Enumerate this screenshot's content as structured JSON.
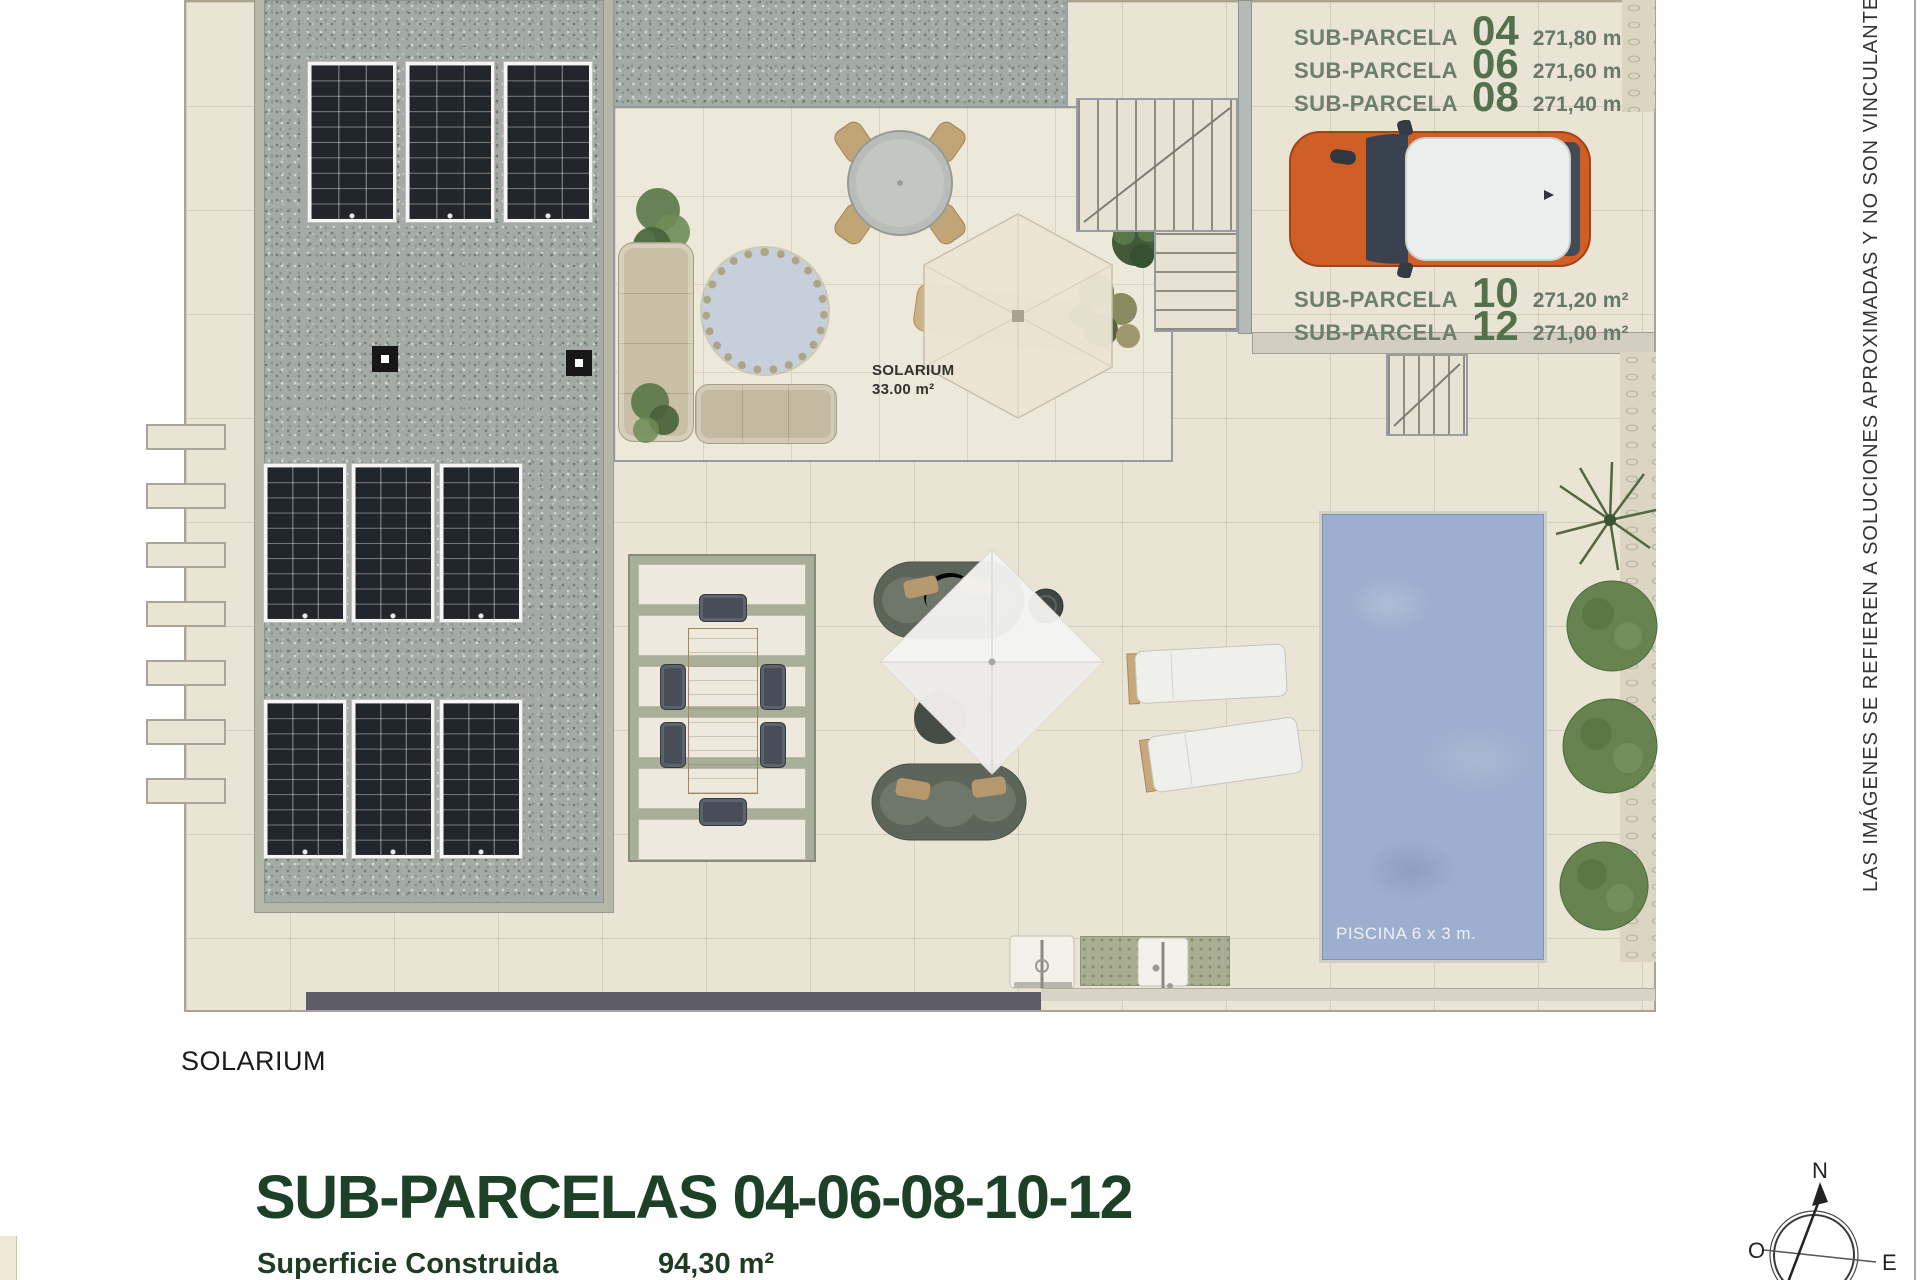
{
  "plan": {
    "subparcelas": [
      {
        "label": "SUB-PARCELA",
        "number": "04",
        "area": "271,80 m²"
      },
      {
        "label": "SUB-PARCELA",
        "number": "06",
        "area": "271,60 m²"
      },
      {
        "label": "SUB-PARCELA",
        "number": "08",
        "area": "271,40 m²"
      },
      {
        "label": "SUB-PARCELA",
        "number": "10",
        "area": "271,20 m²"
      },
      {
        "label": "SUB-PARCELA",
        "number": "12",
        "area": "271,00 m²"
      }
    ],
    "solarium_zone": {
      "name": "SOLARIUM",
      "area": "33.00 m²"
    },
    "pool_label": "PISCINA 6 x 3 m."
  },
  "footer": {
    "level_name": "SOLARIUM",
    "title": "SUB-PARCELAS 04-06-08-10-12",
    "superficie_label": "Superficie Construida",
    "superficie_value": "94,30 m²"
  },
  "disclaimer": "LAS IMÁGENES SE REFIEREN A SOLUCIONES APROXIMADAS Y NO SON VINCULANTES AL PROYECTO",
  "compass": {
    "north": "N",
    "west": "O",
    "east": "E"
  },
  "colors": {
    "title_green": "#1d4126",
    "label_green": "#6d7e6c",
    "number_green": "#53714d",
    "pool_blue": "#9dafce",
    "car_orange": "#d05e27",
    "gravel_gray": "#a4aba7",
    "plan_beige": "#e9e4d4"
  }
}
